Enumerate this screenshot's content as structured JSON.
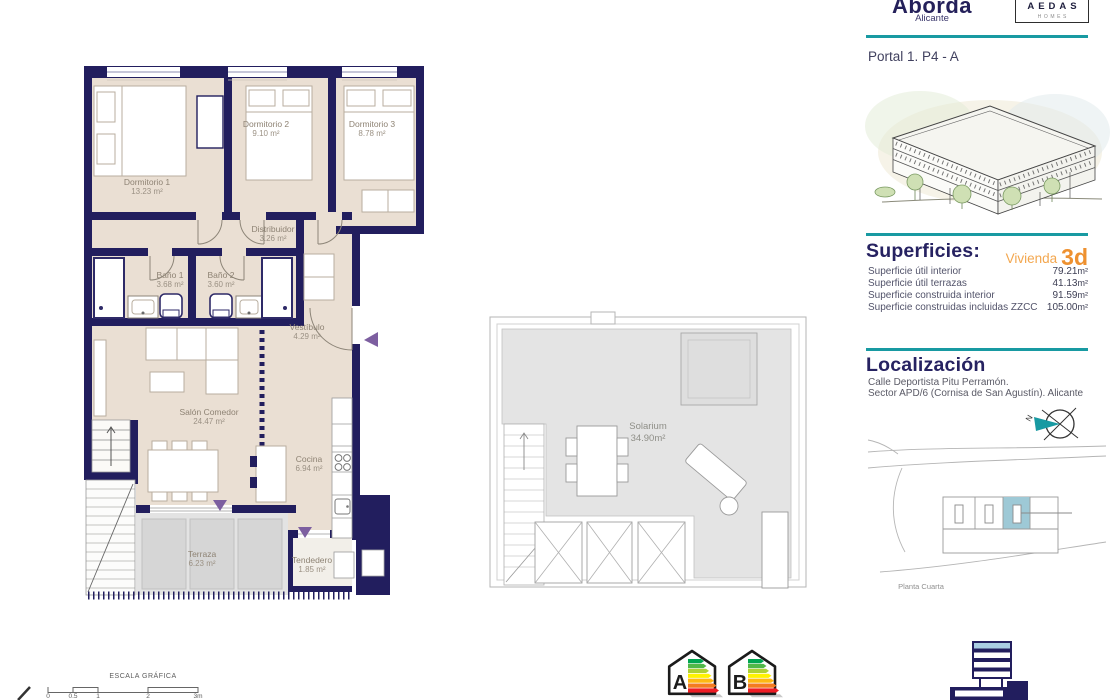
{
  "header": {
    "project_name": "Aborda",
    "project_city": "Alicante",
    "brand_name": "AEDAS",
    "brand_sub": "HOMES",
    "unit_reference": "Portal 1. P4 - A"
  },
  "superficies": {
    "title": "Superficies:",
    "vivienda_label": "Vivienda",
    "vivienda_code": "3d",
    "rows": [
      {
        "label": "Superficie útil interior",
        "value": "79.21",
        "unit": "m²"
      },
      {
        "label": "Superficie útil terrazas",
        "value": "41.13",
        "unit": "m²"
      },
      {
        "label": "Superficie construida interior",
        "value": "91.59",
        "unit": "m²"
      },
      {
        "label": "Superficie construidas incluidas ZZCC",
        "value": "105.00",
        "unit": "m²"
      }
    ]
  },
  "localizacion": {
    "title": "Localización",
    "address_line1": "Calle Deportista Pitu Perramón.",
    "address_line2": "Sector APD/6 (Cornisa de San Agustín). Alicante",
    "compass_letter": "N",
    "plan_caption": "Planta Cuarta"
  },
  "floorplan": {
    "rooms": [
      {
        "name": "Dormitorio 1",
        "area": "13.23 m²"
      },
      {
        "name": "Dormitorio 2",
        "area": "9.10 m²"
      },
      {
        "name": "Dormitorio 3",
        "area": "8.78 m²"
      },
      {
        "name": "Distribuidor",
        "area": "3.26 m²"
      },
      {
        "name": "Baño 1",
        "area": "3.68 m²"
      },
      {
        "name": "Baño 2",
        "area": "3.60 m²"
      },
      {
        "name": "Vestíbulo",
        "area": "4.29 m²"
      },
      {
        "name": "Salón Comedor",
        "area": "24.47 m²"
      },
      {
        "name": "Cocina",
        "area": "6.94 m²"
      },
      {
        "name": "Terraza",
        "area": "6.23 m²"
      },
      {
        "name": "Tendedero",
        "area": "1.85 m²"
      }
    ]
  },
  "solarium": {
    "name": "Solarium",
    "area": "34.90m²"
  },
  "scale_bar": {
    "title": "ESCALA GRÁFICA",
    "ticks": [
      "0",
      "0.5",
      "1",
      "2",
      "3m"
    ]
  },
  "energy": {
    "labels": [
      "A",
      "B"
    ]
  },
  "colors": {
    "navy": "#221e5e",
    "teal": "#189aa2",
    "beige": "#eadfd3",
    "orange": "#ee9130",
    "purple": "#7d5fa0",
    "highlight": "#9ec9d6"
  }
}
